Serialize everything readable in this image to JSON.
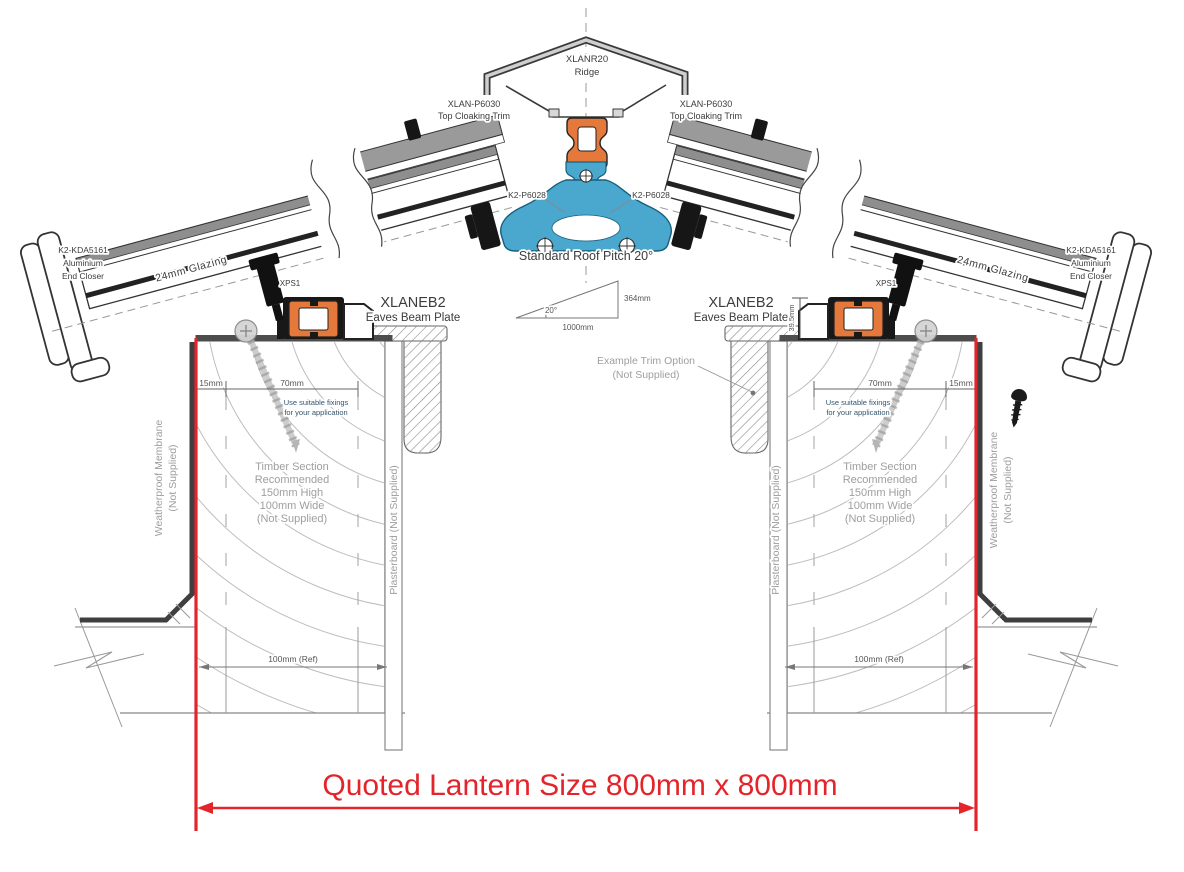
{
  "colors": {
    "accent_red": "#e3242b",
    "extrusion_orange": "#e5793b",
    "ridge_blue": "#4aa8cf",
    "cap_gray": "#8e8e8e"
  },
  "ridge": {
    "code": "XLANR20",
    "name": "Ridge"
  },
  "cloaking_trim": {
    "code": "XLAN-P6030",
    "name": "Top Cloaking Trim"
  },
  "ridge_clamp_code": "K2-P6028",
  "pitch": {
    "caption": "Standard Roof Pitch 20°",
    "angle": "20°",
    "run": "1000mm",
    "rise": "364mm"
  },
  "end_closer": {
    "code": "K2-KDA5161",
    "line2": "Aluminium",
    "line3": "End Closer"
  },
  "glazing_label": "24mm Glazing",
  "packer_code": "XPS1",
  "eaves_beam": {
    "code": "XLANEB2",
    "name": "Eaves Beam Plate",
    "height": "39.5mm"
  },
  "trim_option": {
    "line1": "Example Trim Option",
    "line2": "(Not Supplied)"
  },
  "fixing_note": {
    "line1": "Use suitable fixings",
    "line2": "for your application"
  },
  "timber_note": [
    "Timber Section",
    "Recommended",
    "150mm High",
    "100mm Wide",
    "(Not Supplied)"
  ],
  "membrane_note": {
    "line1": "Weatherproof Membrane",
    "line2": "(Not Supplied)"
  },
  "plasterboard_note": "Plasterboard (Not Supplied)",
  "dimensions": {
    "edge": "15mm",
    "fixing_zone": "70mm",
    "wall_ref": "100mm (Ref)"
  },
  "quoted_size": "Quoted Lantern Size 800mm x 800mm"
}
